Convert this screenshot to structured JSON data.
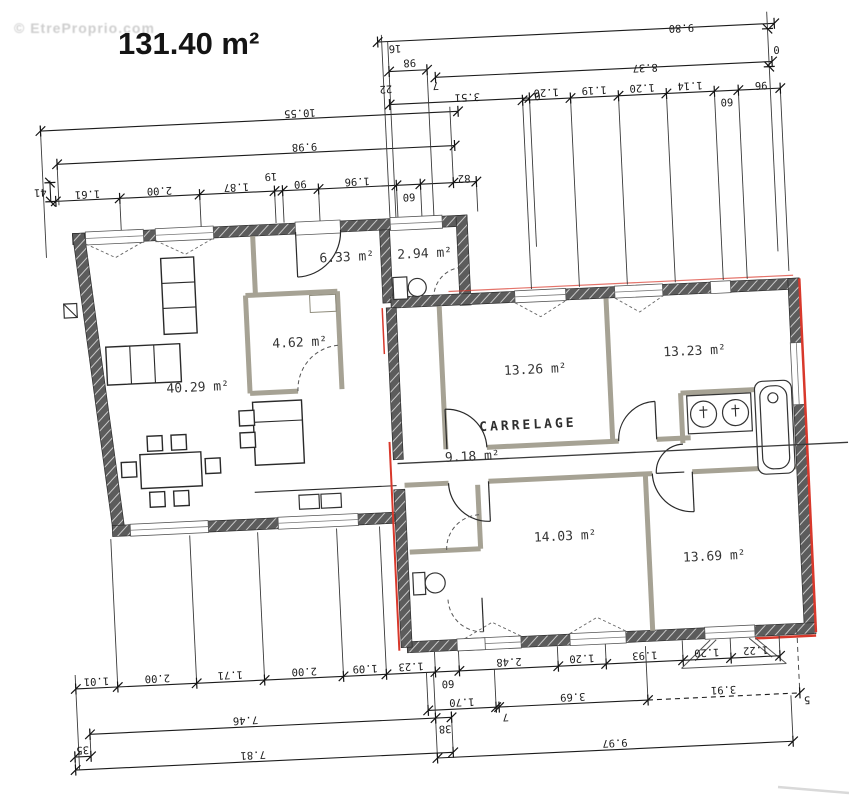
{
  "watermark": "© EtreProprio.com",
  "title": "131.40 m²",
  "colors": {
    "exterior_wall": "#5c5c5c",
    "interior_wall": "#a6a294",
    "accent_red": "#d8382b",
    "line": "#1c1c1c"
  },
  "rooms": {
    "living": "40.29 m²",
    "storage": "4.62 m²",
    "entry": "6.33 m²",
    "wc": "2.94 m²",
    "bedroom1": "13.26 m²",
    "bedroom2": "13.23 m²",
    "hall": "9.18 m²",
    "hall_floor": "CARRELAGE",
    "bedroom3": "14.03 m²",
    "bedroom4": "13.69 m²"
  },
  "dims": {
    "top_overall": [
      "9.80",
      "8.37"
    ],
    "top_small": [
      "16",
      "98",
      "22",
      "7",
      "3.51",
      "0"
    ],
    "top_chain": [
      "1.20",
      "1.19",
      "1.20",
      "1.14",
      "60",
      "96"
    ],
    "right_zero": "0",
    "left_overall": [
      "10.55",
      "9.98"
    ],
    "left_offset": "41",
    "left_chain": [
      "1.61",
      "2.00",
      "1.87",
      "19",
      "90",
      "1.96",
      "60",
      "82"
    ],
    "bottom_chain": [
      "1.01",
      "2.00",
      "1.71",
      "2.00",
      "1.09",
      "1.23",
      "60",
      "2.48",
      "1.20",
      "1.93",
      "1.20",
      "1.22"
    ],
    "bottom_mid": [
      "1.70",
      "7",
      "3.69",
      "3.91",
      "5"
    ],
    "bottom_overall": [
      "7.46",
      "38",
      "35",
      "7.81",
      "9.97"
    ]
  }
}
